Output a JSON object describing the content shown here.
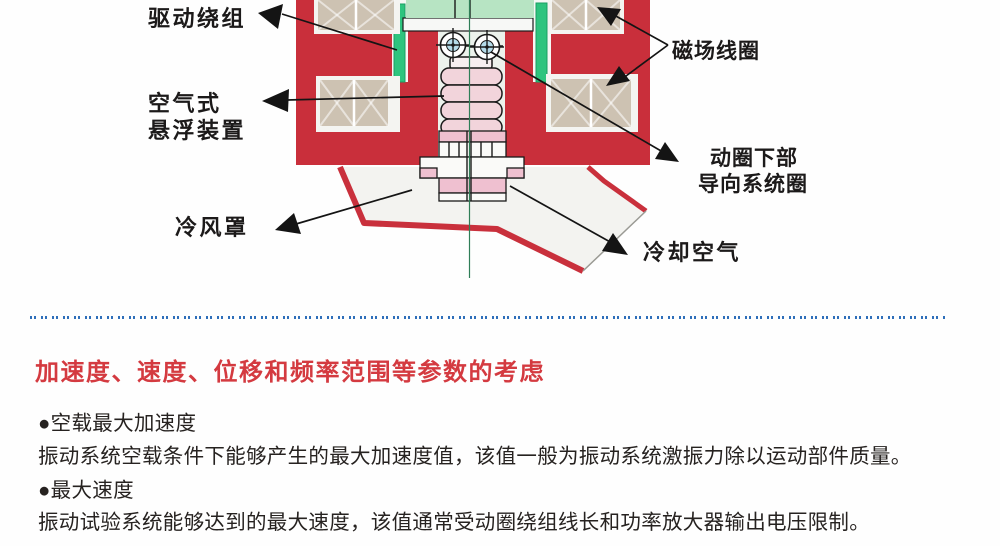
{
  "diagram": {
    "labels": {
      "drive_winding": "驱动绕组",
      "air_suspension_line1": "空气式",
      "air_suspension_line2": "悬浮装置",
      "cooling_shroud": "冷风罩",
      "field_coil": "磁场线圈",
      "guide_line1": "动圈下部",
      "guide_line2": "导向系统圈",
      "cooling_air": "冷却空气"
    },
    "colors": {
      "body_red": "#c92f3b",
      "coil_tan": "#cdc2b2",
      "table_green": "#b7e4c3",
      "moving_coil_green": "#2ec47e",
      "cavity": "#ecf2ec",
      "bellows_pink": "#f2d4db",
      "pink": "#efc0d0",
      "shroud": "#f3f3f0",
      "axis_green": "#2f7e57",
      "bearing_blue": "#b5dcea"
    }
  },
  "divider": {
    "color": "#2e6fba"
  },
  "section": {
    "heading": "加速度、速度、位移和频率范围等参数的考虑",
    "heading_color": "#d43a40",
    "items": [
      {
        "bullet": "●空载最大加速度",
        "body": "振动系统空载条件下能够产生的最大加速度值，该值一般为振动系统激振力除以运动部件质量。"
      },
      {
        "bullet": "●最大速度",
        "body": "振动试验系统能够达到的最大速度，该值通常受动圈绕组线长和功率放大器输出电压限制。"
      }
    ]
  }
}
